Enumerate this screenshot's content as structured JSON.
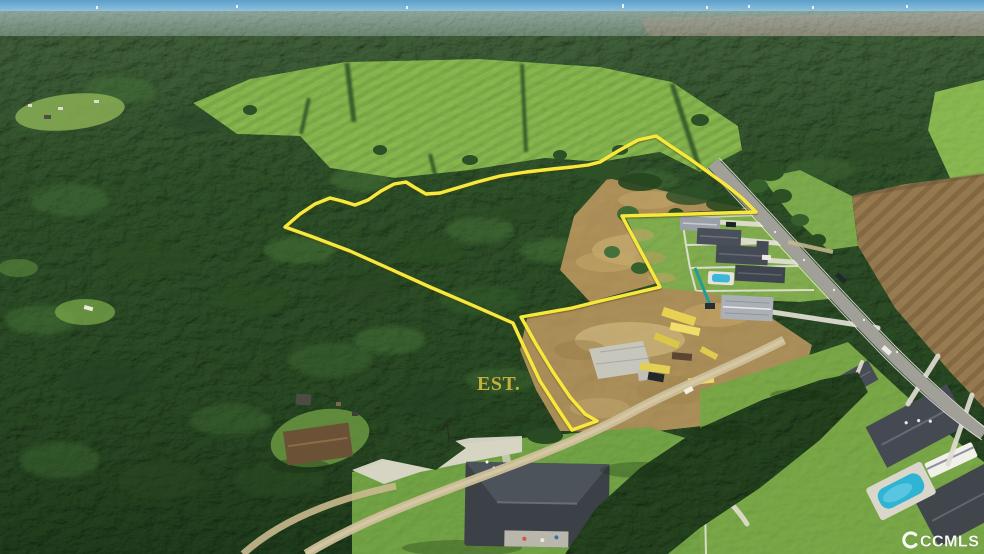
{
  "photo": {
    "kind": "aerial-drone-listing-photo",
    "label": {
      "text": "EST."
    },
    "watermark": {
      "text": "CCMLS"
    },
    "colors": {
      "boundary": "#f8e73e",
      "label": "#c4b03c",
      "watermark": "#ffffff",
      "sky": "#5b9fca",
      "forest": "#2c4c26",
      "field": "#8aba50",
      "dirt": "#b3945c",
      "plowed": "#9c7f53",
      "road": "#a0a098",
      "pool": "#3db7d8"
    }
  }
}
